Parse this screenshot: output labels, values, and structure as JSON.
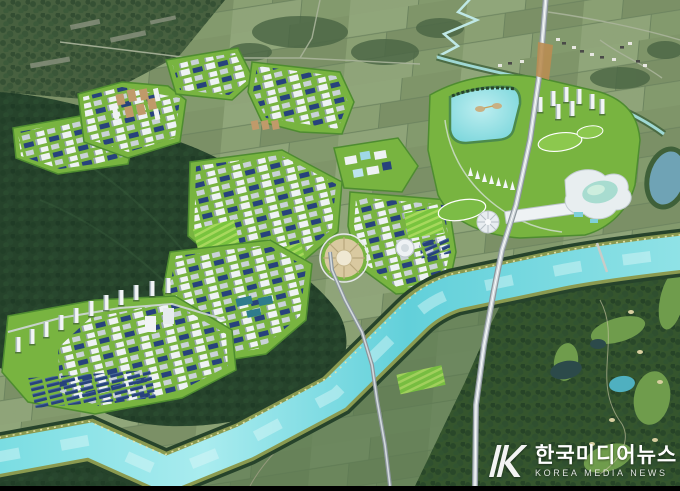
{
  "image": {
    "description": "Aerial bird's-eye 3D master-plan rendering of a planned industrial city complex: white factory districts and apartment towers on landscaped green platforms between dark forested mountains, a rectangular lake park with resort and waterpark, a turquoise river bending around the site, a vertical expressway, farmland to the north and a golf course to the south-east."
  },
  "watermark": {
    "korean": "한국미디어뉴스",
    "english": "KOREA MEDIA NEWS",
    "logo_monogram": "HK"
  },
  "palette": {
    "farmland": "#869970",
    "farmlandDark": "#5d7a52",
    "forest": "#26432b",
    "forestLight": "#3c6040",
    "dev": "#78b440",
    "devLight": "#a6d85c",
    "buildingWhite": "#eef2f4",
    "buildingShadow": "#9aa8b0",
    "roofBlue": "#27427c",
    "roofTan": "#c09a6a",
    "river": "#63d1da",
    "riverHighlight": "#ddf8f8",
    "lake": "#7fd6da",
    "road": "#8c969c",
    "roadLight": "#d2d9dd",
    "golf": "#35552d",
    "fairway": "#6f9c4c",
    "sand": "#d8cfa0",
    "soil": "#b98d52",
    "pond": "#6fa3b5",
    "watermark": "#ffffff"
  }
}
